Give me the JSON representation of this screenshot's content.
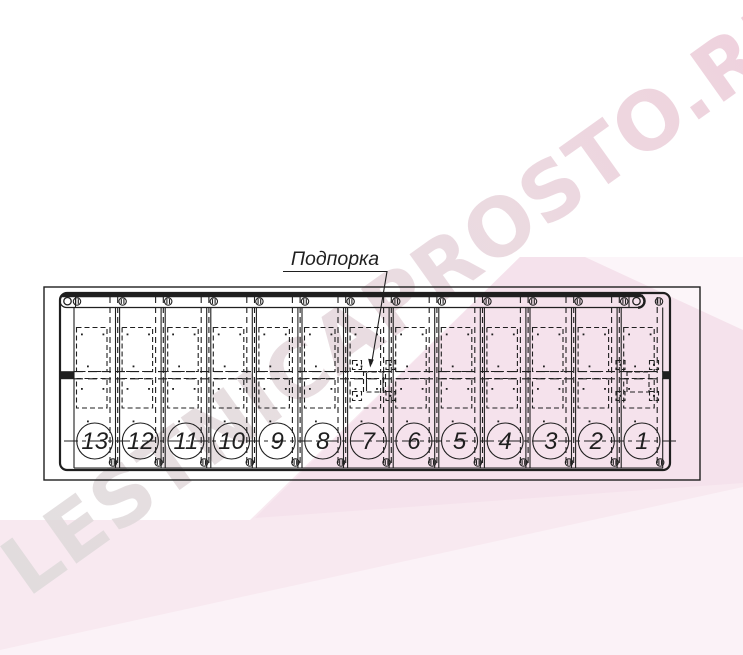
{
  "watermark": {
    "text": "LESTNICAPROSTO.RU"
  },
  "drawing": {
    "label": "Подпорка",
    "steps": [
      "13",
      "12",
      "11",
      "10",
      "9",
      "8",
      "7",
      "6",
      "5",
      "4",
      "3",
      "2",
      "1"
    ]
  },
  "colors": {
    "line": "#1f1f1f",
    "pink_base": "#f8e9f0",
    "pink_deep": "#f5e1eb",
    "pink_light": "#fbf2f7",
    "pink_faint": "#fcf5f9",
    "watermark_from": "#dcd9d9",
    "watermark_mid": "#e6d3da",
    "watermark_to": "#edc6d6"
  }
}
